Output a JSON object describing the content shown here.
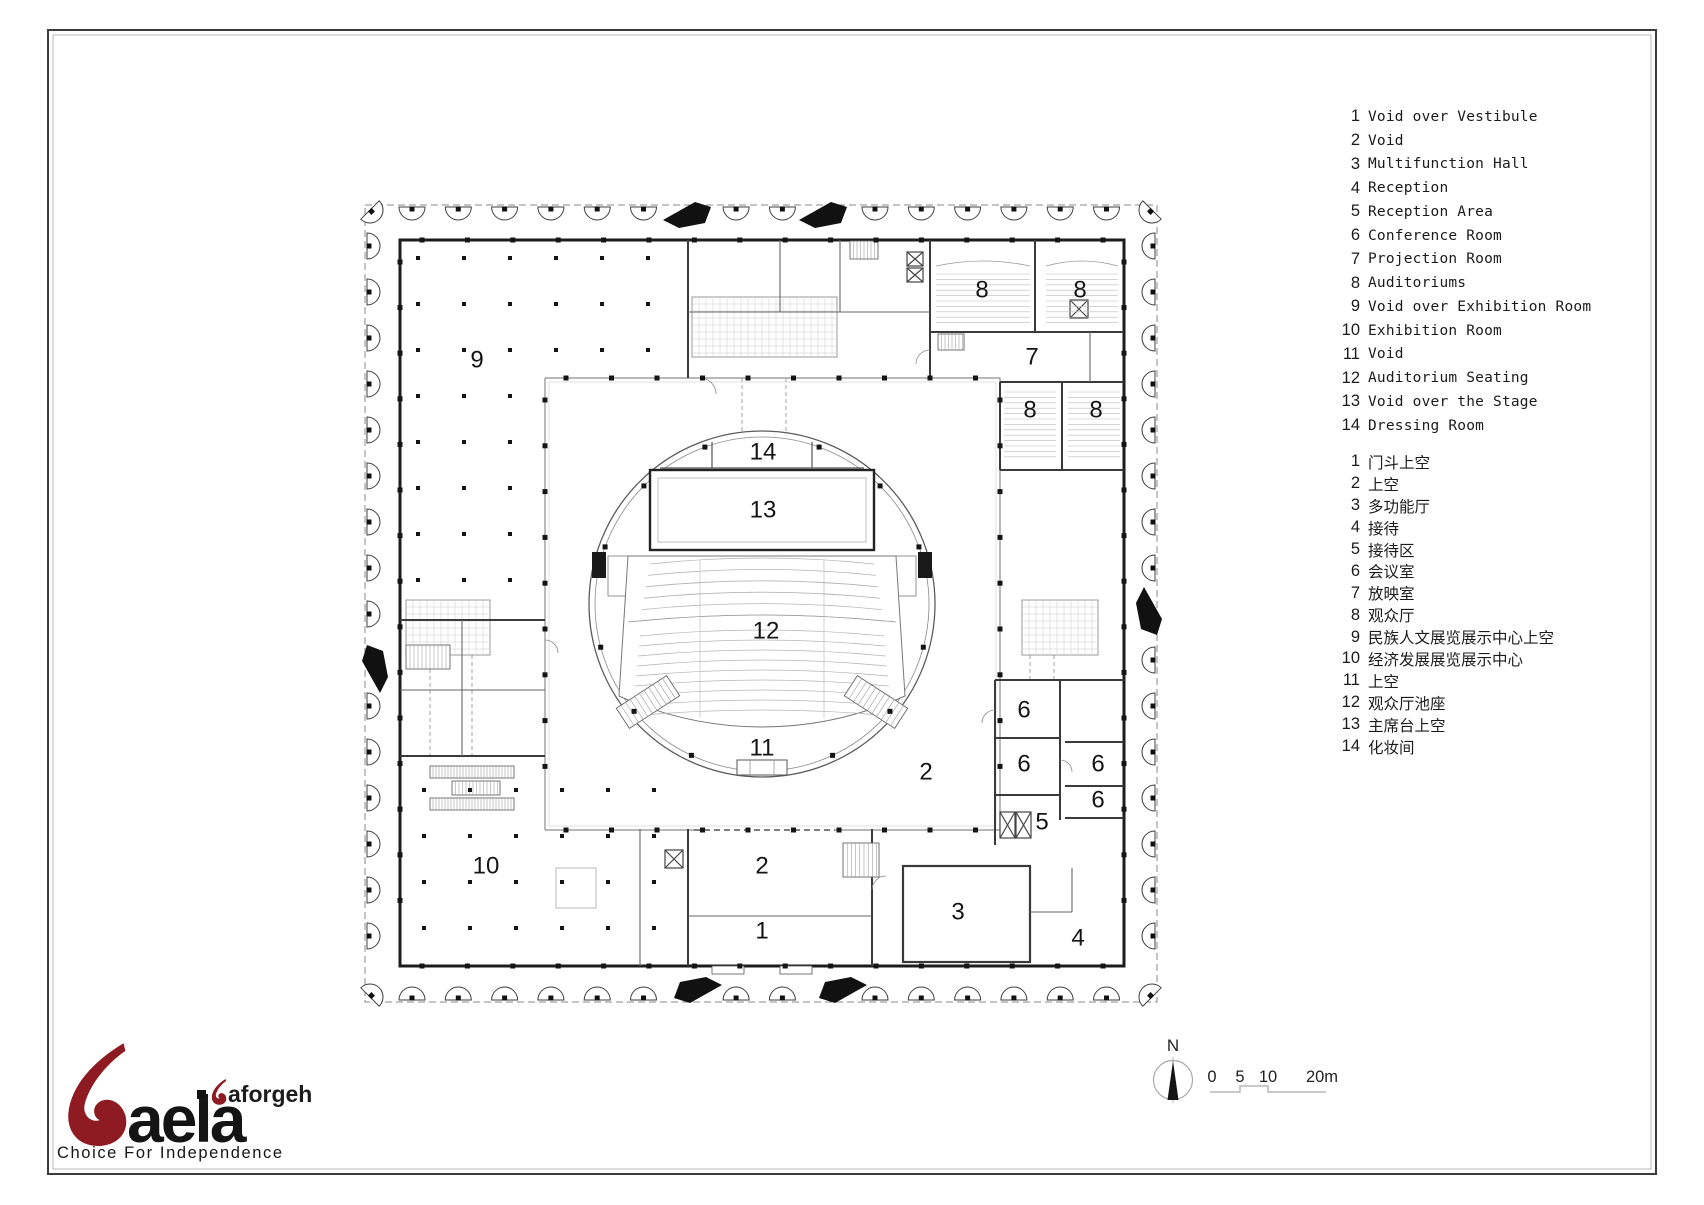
{
  "legend": {
    "english": [
      {
        "num": "1",
        "label": "Void over Vestibule"
      },
      {
        "num": "2",
        "label": "Void"
      },
      {
        "num": "3",
        "label": "Multifunction Hall"
      },
      {
        "num": "4",
        "label": "Reception"
      },
      {
        "num": "5",
        "label": "Reception Area"
      },
      {
        "num": "6",
        "label": "Conference Room"
      },
      {
        "num": "7",
        "label": "Projection Room"
      },
      {
        "num": "8",
        "label": "Auditoriums"
      },
      {
        "num": "9",
        "label": "Void over Exhibition Room"
      },
      {
        "num": "10",
        "label": "Exhibition Room"
      },
      {
        "num": "11",
        "label": "Void"
      },
      {
        "num": "12",
        "label": "Auditorium Seating"
      },
      {
        "num": "13",
        "label": "Void over the Stage"
      },
      {
        "num": "14",
        "label": "Dressing Room"
      }
    ],
    "chinese": [
      {
        "num": "1",
        "label": "门斗上空"
      },
      {
        "num": "2",
        "label": "上空"
      },
      {
        "num": "3",
        "label": "多功能厅"
      },
      {
        "num": "4",
        "label": "接待"
      },
      {
        "num": "5",
        "label": "接待区"
      },
      {
        "num": "6",
        "label": "会议室"
      },
      {
        "num": "7",
        "label": "放映室"
      },
      {
        "num": "8",
        "label": "观众厅"
      },
      {
        "num": "9",
        "label": "民族人文展览展示中心上空"
      },
      {
        "num": "10",
        "label": "经济发展展览展示中心"
      },
      {
        "num": "11",
        "label": "上空"
      },
      {
        "num": "12",
        "label": "观众厅池座"
      },
      {
        "num": "13",
        "label": "主席台上空"
      },
      {
        "num": "14",
        "label": "化妆间"
      }
    ]
  },
  "plan": {
    "room_labels": [
      {
        "text": "9",
        "x": 477,
        "y": 360
      },
      {
        "text": "8",
        "x": 982,
        "y": 290
      },
      {
        "text": "8",
        "x": 1080,
        "y": 290
      },
      {
        "text": "7",
        "x": 1032,
        "y": 357
      },
      {
        "text": "8",
        "x": 1030,
        "y": 410
      },
      {
        "text": "8",
        "x": 1096,
        "y": 410
      },
      {
        "text": "14",
        "x": 763,
        "y": 452
      },
      {
        "text": "13",
        "x": 763,
        "y": 510
      },
      {
        "text": "12",
        "x": 766,
        "y": 631
      },
      {
        "text": "11",
        "x": 762,
        "y": 748
      },
      {
        "text": "2",
        "x": 926,
        "y": 772
      },
      {
        "text": "6",
        "x": 1024,
        "y": 710
      },
      {
        "text": "6",
        "x": 1024,
        "y": 764
      },
      {
        "text": "6",
        "x": 1098,
        "y": 764
      },
      {
        "text": "6",
        "x": 1098,
        "y": 800
      },
      {
        "text": "5",
        "x": 1042,
        "y": 822
      },
      {
        "text": "10",
        "x": 486,
        "y": 866
      },
      {
        "text": "2",
        "x": 762,
        "y": 866
      },
      {
        "text": "1",
        "x": 762,
        "y": 931
      },
      {
        "text": "3",
        "x": 958,
        "y": 912
      },
      {
        "text": "4",
        "x": 1078,
        "y": 938
      }
    ]
  },
  "compass": {
    "north_label": "N"
  },
  "scale_bar": {
    "labels": [
      {
        "text": "0",
        "x": 1212
      },
      {
        "text": "5",
        "x": 1240
      },
      {
        "text": "10",
        "x": 1268
      },
      {
        "text": "20m",
        "x": 1322
      }
    ]
  },
  "logo": {
    "brand": "aela",
    "sub_brand": "aforgeh",
    "tagline": "Choice For Independence",
    "accent_color": "#8e1b21",
    "text_color": "#141414"
  },
  "colors": {
    "wall": "#1c1c1c",
    "partition": "#3a3a3a",
    "light_line": "#999999",
    "boundary_dash": "#888888"
  }
}
